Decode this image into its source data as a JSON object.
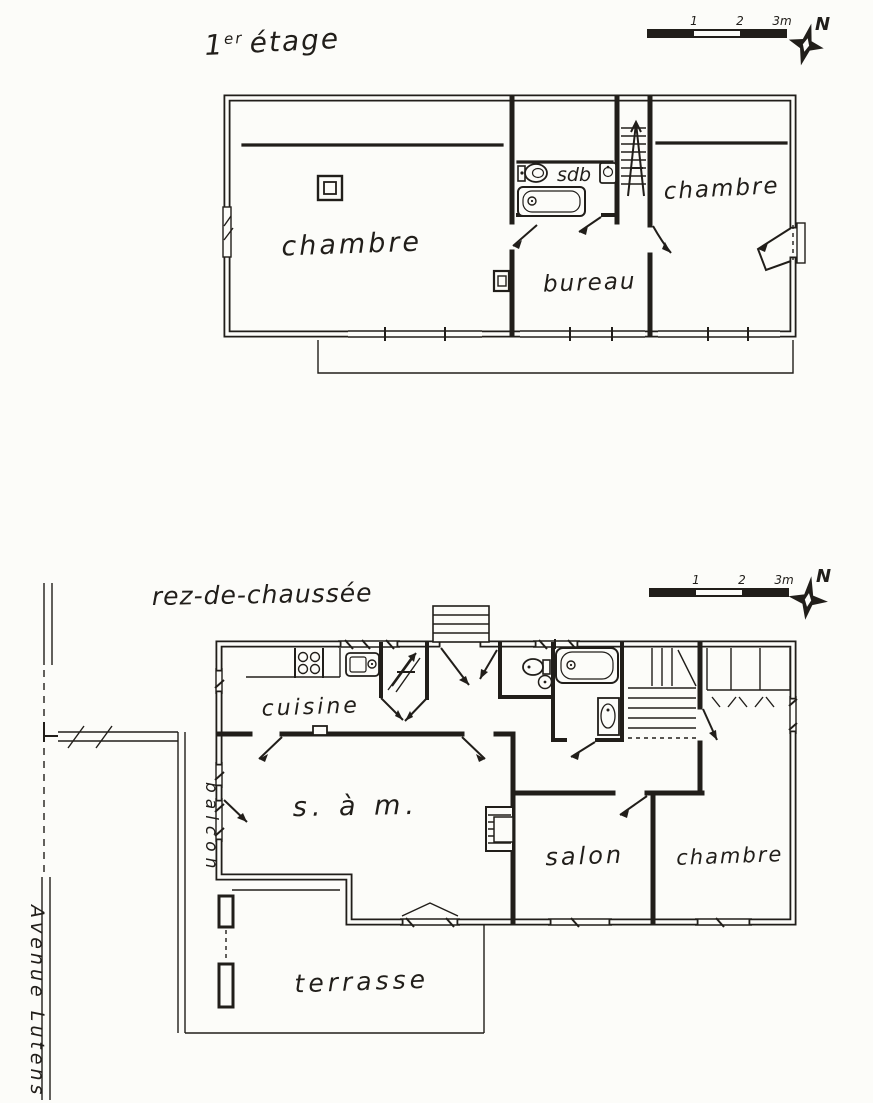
{
  "floor1": {
    "title": {
      "num": "1",
      "sup": "er",
      "word": "étage"
    },
    "scale_bar": {
      "ticks": [
        "1",
        "2",
        "3m"
      ]
    },
    "compass": {
      "north": "N"
    },
    "rooms": {
      "chambre_left": "chambre",
      "sdb": "sdb",
      "chambre_right": "chambre",
      "bureau": "bureau"
    }
  },
  "floor0": {
    "title": "rez-de-chaussée",
    "scale_bar": {
      "ticks": [
        "1",
        "2",
        "3m"
      ]
    },
    "compass": {
      "north": "N"
    },
    "rooms": {
      "cuisine": "cuisine",
      "salle_a_manger": "s. à m.",
      "salon": "salon",
      "chambre": "chambre",
      "balcon": "balcon",
      "terrasse": "terrasse"
    },
    "street": "Avenue Lutens"
  },
  "colors": {
    "ink": "#211e1a",
    "paper": "#fcfcf9"
  }
}
